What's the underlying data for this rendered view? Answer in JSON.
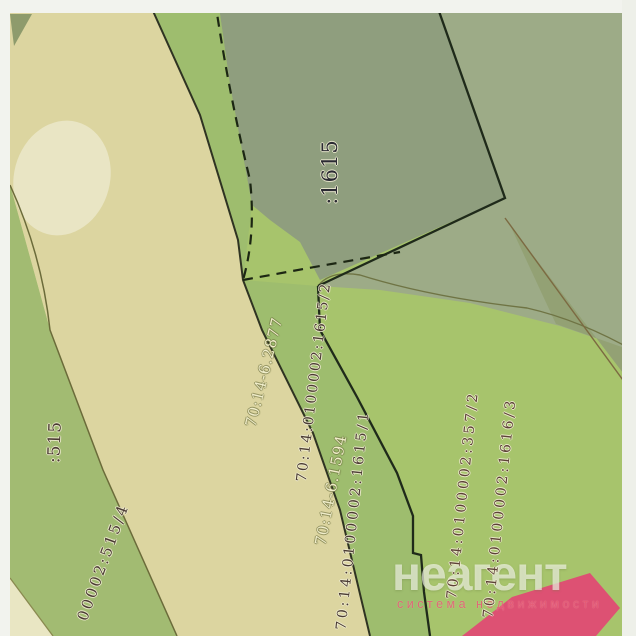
{
  "map": {
    "type": "cadastral-plan-scan",
    "labels": [
      {
        "id": "parcel-1615",
        "text": ":1615"
      },
      {
        "id": "parcel-2877",
        "text": "70:14-6.2877"
      },
      {
        "id": "parcel-1615-2",
        "text": "70:14:0100002:1615/2"
      },
      {
        "id": "parcel-1594",
        "text": "70:14-6.1594"
      },
      {
        "id": "parcel-1615-1",
        "text": "70:14:0100002:1615/1"
      },
      {
        "id": "parcel-357-2",
        "text": "70:14:0100002:357/2"
      },
      {
        "id": "parcel-1616-3",
        "text": "70:14:0100002:1616/3"
      },
      {
        "id": "parcel-515",
        "text": ":515"
      },
      {
        "id": "parcel-515-4",
        "text": "00002:515/4"
      }
    ],
    "colors": {
      "base_green": "#a7c46c",
      "strip_green": "#9ebd6e",
      "left_green": "#a2bb72",
      "sage_topright": "#9dab87",
      "sage_1615": "#8f9e7e",
      "olive_sliver": "#93a174",
      "beige_band": "#dcd5a0",
      "pale_triangle": "#e9e6c3",
      "building_pink": "#dd5173",
      "boundary_dark": "#222d18",
      "boundary_olive": "#6f7444",
      "boundary_brown": "#7c6a42",
      "scan_margin": "#f2f3ee"
    }
  },
  "watermark": {
    "brand": "неагент",
    "tagline": "система недвижимости"
  }
}
